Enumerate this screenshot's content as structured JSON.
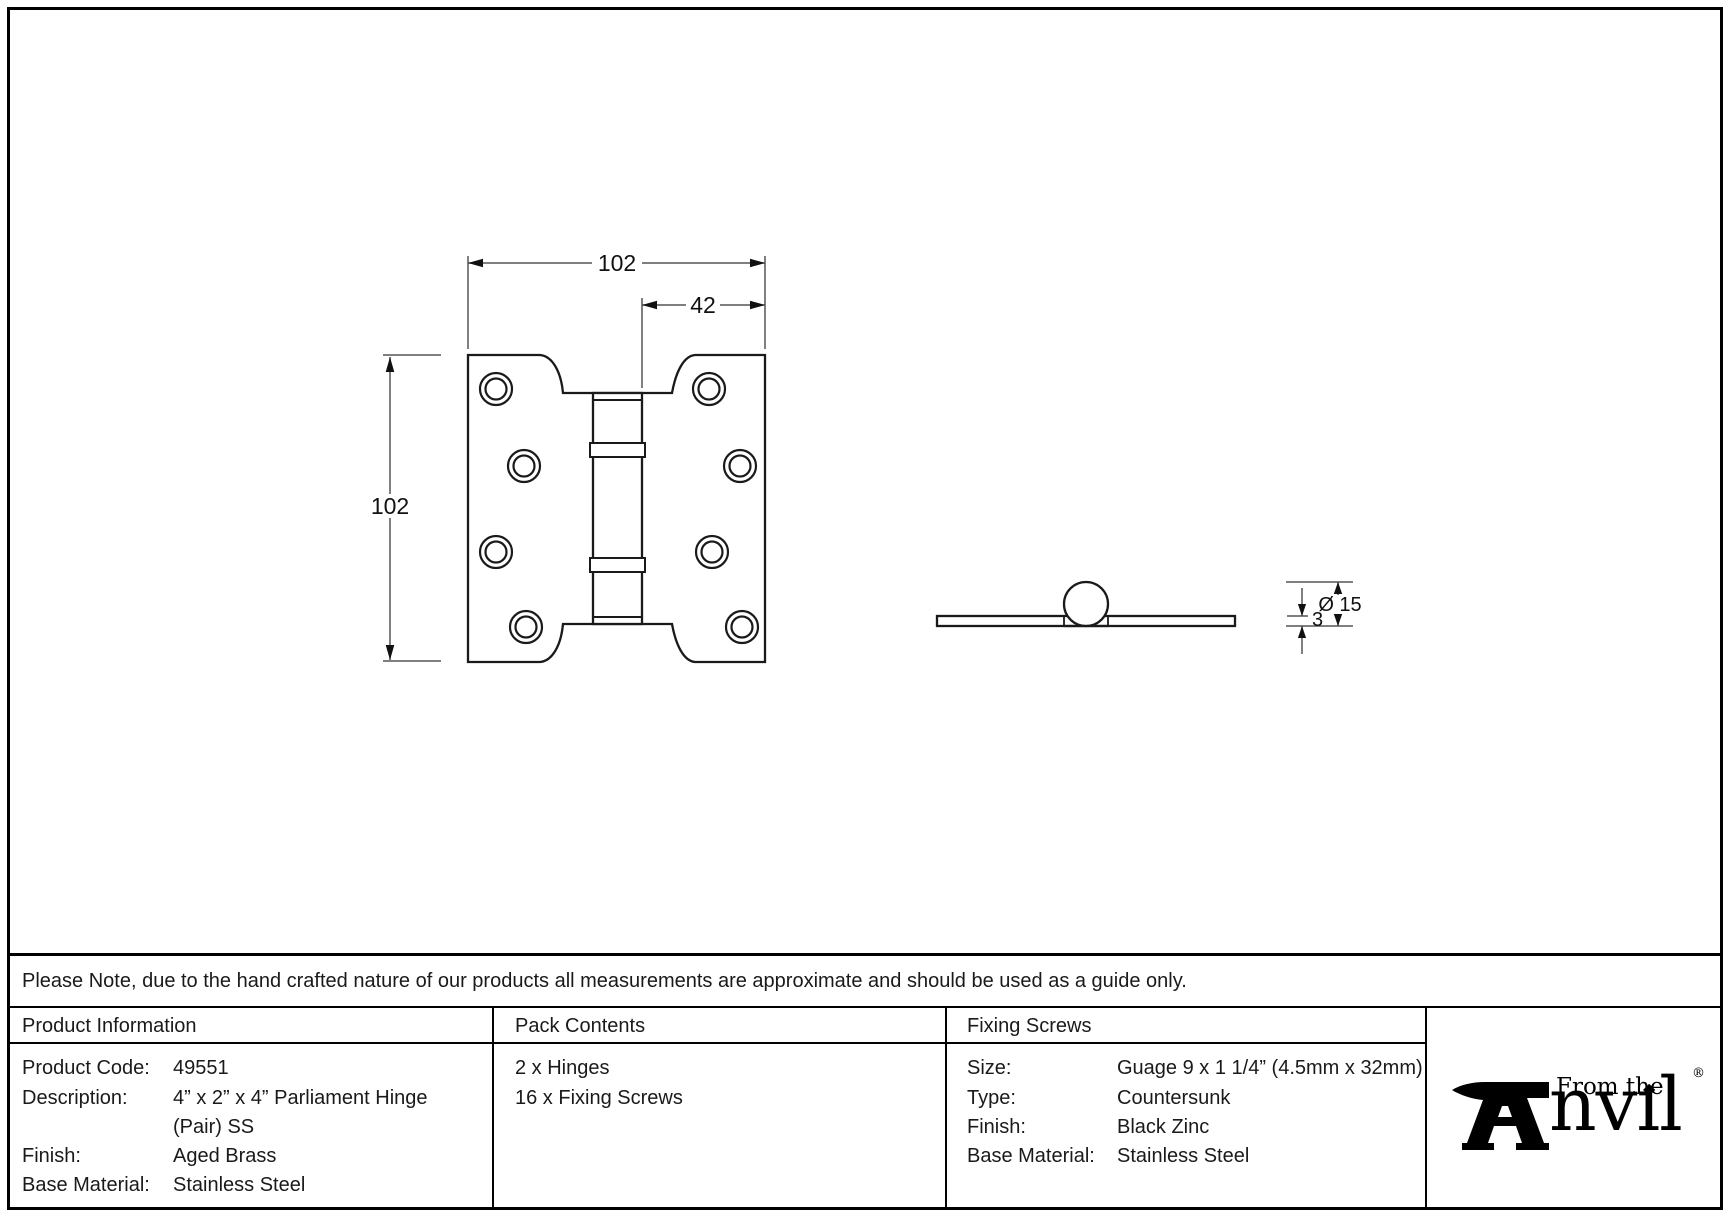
{
  "colors": {
    "ink": "#1a1a1a",
    "dim_line": "#555555"
  },
  "drawing": {
    "front_view": {
      "dim_width": "102",
      "dim_offset": "42",
      "dim_height": "102"
    },
    "side_view": {
      "dim_diameter": "Ø 15",
      "dim_thickness": "3"
    }
  },
  "note": "Please Note, due to the hand crafted nature of our products all measurements are approximate and should be used as a guide only.",
  "table": {
    "product_information": {
      "header": "Product Information",
      "rows": [
        {
          "label": "Product Code:",
          "value": "49551"
        },
        {
          "label": "Description:",
          "value": "4” x 2” x 4” Parliament Hinge"
        },
        {
          "label": "",
          "value": "(Pair) SS"
        },
        {
          "label": "Finish:",
          "value": "Aged Brass"
        },
        {
          "label": "Base Material:",
          "value": "Stainless Steel"
        }
      ]
    },
    "pack_contents": {
      "header": "Pack Contents",
      "items": [
        "2 x Hinges",
        "16 x Fixing Screws"
      ]
    },
    "fixing_screws": {
      "header": "Fixing Screws",
      "rows": [
        {
          "label": "Size:",
          "value": "Guage 9 x 1 1/4” (4.5mm x 32mm)"
        },
        {
          "label": "Type:",
          "value": "Countersunk"
        },
        {
          "label": "Finish:",
          "value": "Black Zinc"
        },
        {
          "label": "Base Material:",
          "value": "Stainless Steel"
        }
      ]
    }
  },
  "logo": {
    "from_the": "From the",
    "anvil_text": "nvıl",
    "registered": "®"
  }
}
